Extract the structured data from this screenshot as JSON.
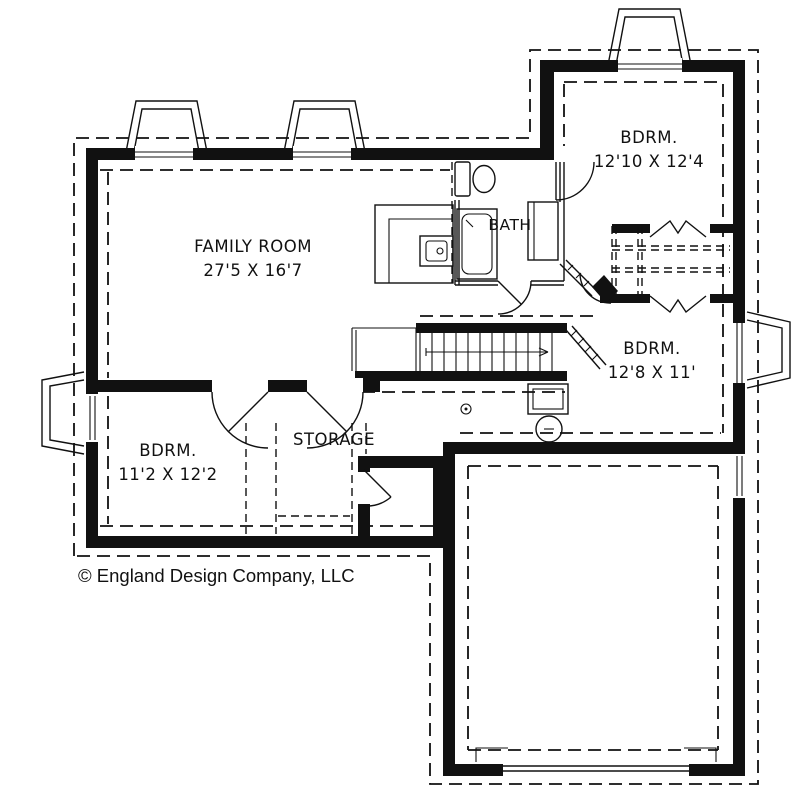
{
  "colors": {
    "line": "#111111",
    "background": "#ffffff"
  },
  "rooms": {
    "family_room": {
      "name": "FAMILY ROOM",
      "dims": "27'5 X 16'7"
    },
    "bedroom_top_right": {
      "name": "BDRM.",
      "dims": "12'10 X 12'4"
    },
    "bedroom_right": {
      "name": "BDRM.",
      "dims": "12'8 X 11'"
    },
    "bedroom_bottom_left": {
      "name": "BDRM.",
      "dims": "11'2 X 12'2"
    },
    "bath": {
      "name": "BATH"
    },
    "storage": {
      "name": "STORAGE"
    }
  },
  "footer": {
    "copyright": "© England Design Company, LLC"
  }
}
